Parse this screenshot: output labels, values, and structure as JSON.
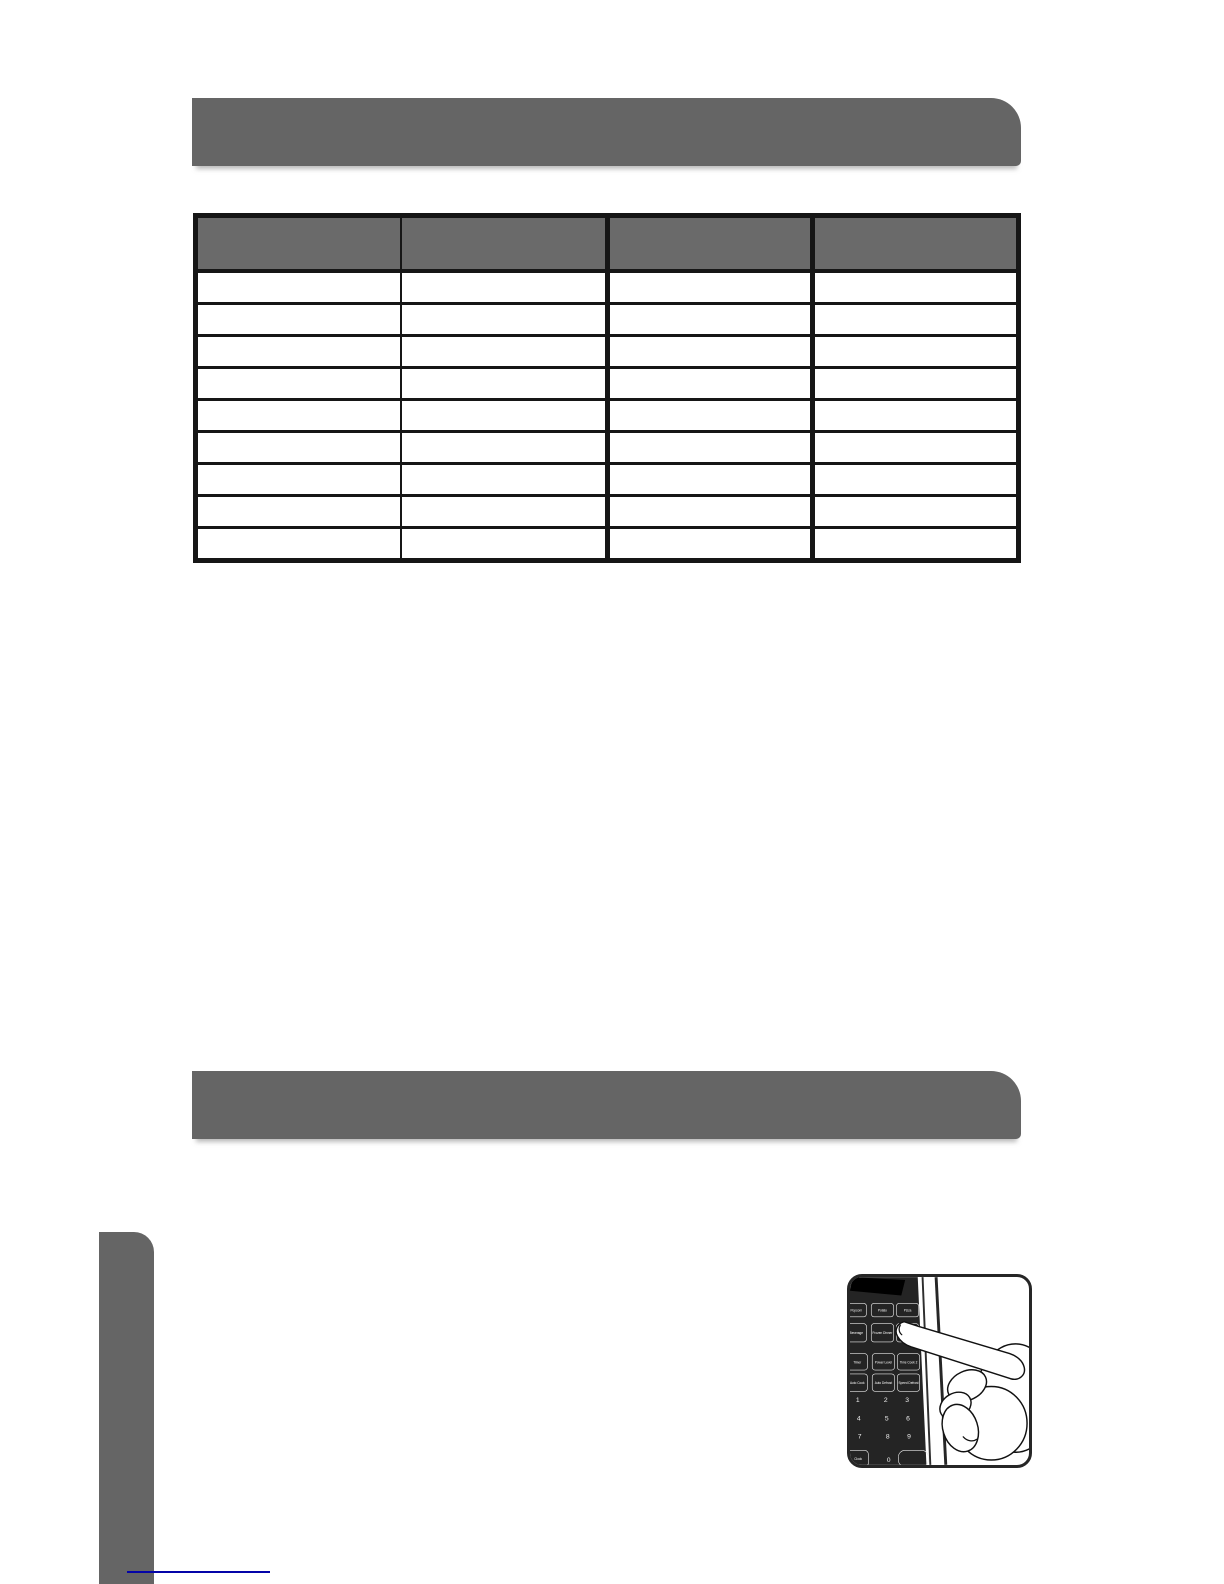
{
  "page": {
    "background": "#ffffff"
  },
  "section_headers": [
    {
      "label": ""
    },
    {
      "label": ""
    }
  ],
  "table": {
    "columns": [
      "",
      "",
      "",
      ""
    ],
    "rows": [
      [
        "",
        "",
        "",
        ""
      ],
      [
        "",
        "",
        "",
        ""
      ],
      [
        "",
        "",
        "",
        ""
      ],
      [
        "",
        "",
        "",
        ""
      ],
      [
        "",
        "",
        "",
        ""
      ],
      [
        "",
        "",
        "",
        ""
      ],
      [
        "",
        "",
        "",
        ""
      ],
      [
        "",
        "",
        "",
        ""
      ],
      [
        "",
        "",
        "",
        ""
      ]
    ]
  },
  "footer_link": {
    "text": ""
  },
  "figure": {
    "keypad": {
      "function_buttons": [
        [
          "Popcorn",
          "Potato",
          "Pizza"
        ],
        [
          "Beverage",
          "Frozen Dinner",
          "Reheat"
        ],
        [
          "Timer",
          "Power Level",
          "Time Cook 2"
        ],
        [
          "Auto Cook",
          "Auto Defrost",
          "Speed Defrost"
        ]
      ],
      "digits": [
        "1",
        "2",
        "3",
        "4",
        "5",
        "6",
        "7",
        "8",
        "9"
      ],
      "bottom_row": [
        "Clock",
        "0",
        ""
      ]
    }
  },
  "colors": {
    "bar_gray": "#656565",
    "table_header_gray": "#6a6a6a",
    "border_black": "#161616",
    "link_blue": "#0404a8",
    "panel_black": "#242424"
  }
}
